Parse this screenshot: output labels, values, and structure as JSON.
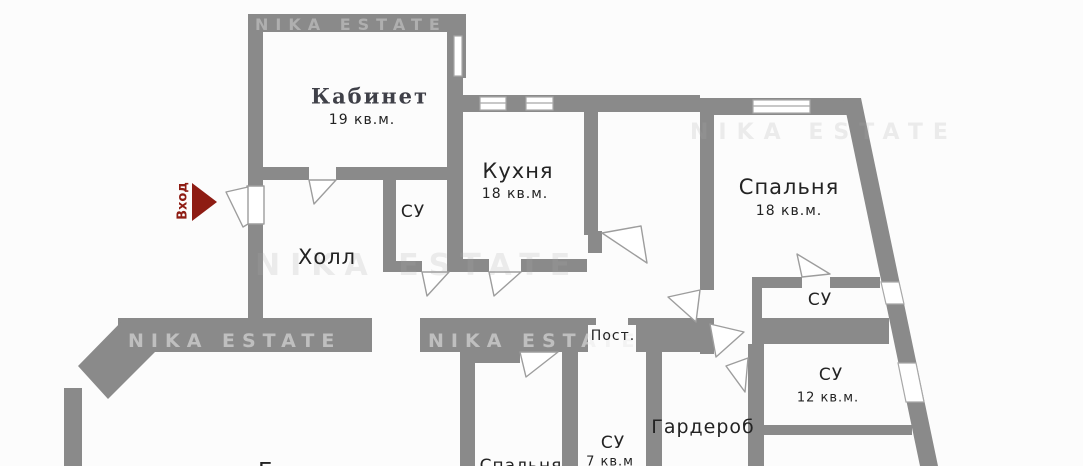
{
  "plan": {
    "watermark": "NIKA ESTATE",
    "entrance": {
      "label": "Вход",
      "arrow_color": "#8e1c13"
    },
    "colors": {
      "wall": "#8a8a8a",
      "door_stroke": "#9d9d9d",
      "label": "#232323",
      "kabinet_label": "#3f4048",
      "background": "#fcfcfc"
    },
    "rooms": {
      "kabinet": {
        "name": "Кабинет",
        "area": "19 кв.м."
      },
      "kitchen": {
        "name": "Кухня",
        "area": "18 кв.м."
      },
      "bedroom": {
        "name": "Спальня",
        "area": "18 кв.м."
      },
      "hall": {
        "name": "Холл"
      },
      "wc_hall": {
        "name": "СУ"
      },
      "storage": {
        "name": "Пост."
      },
      "wc_top_right": {
        "name": "СУ"
      },
      "wc_right": {
        "name": "СУ",
        "area": "12 кв.м."
      },
      "wardrobe": {
        "name": "Гардероб"
      },
      "wc_bottom": {
        "name": "СУ",
        "area": "7 кв.м"
      },
      "living_partial": {
        "name": "Гостиная"
      },
      "bedroom2_partial": {
        "name": "Спальня"
      }
    }
  }
}
